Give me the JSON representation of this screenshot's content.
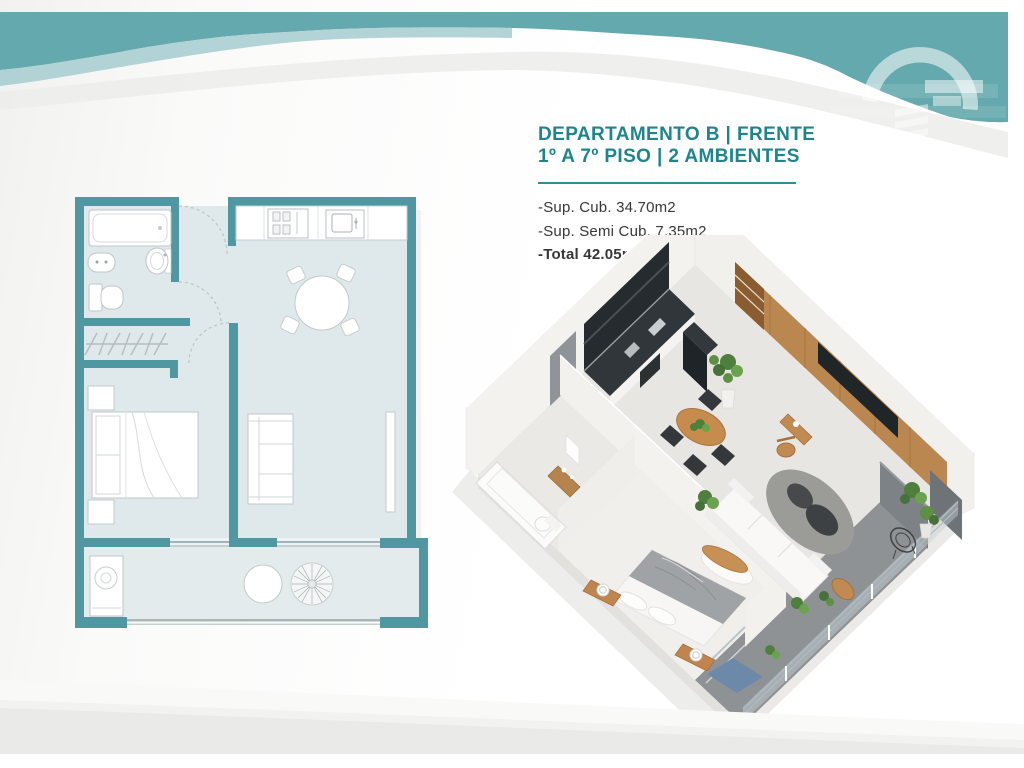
{
  "listing": {
    "title_line1": "DEPARTAMENTO B | FRENTE",
    "title_line2": "1º A 7º PISO | 2 AMBIENTES",
    "details": [
      {
        "label": "-Sup. Cub. 34.70m2",
        "bold": false
      },
      {
        "label": "-Sup. Semi Cub. 7.35m2",
        "bold": false
      },
      {
        "label": "-Total 42.05m2",
        "bold": true
      }
    ]
  },
  "header": {
    "logo": "building-arc-watermark",
    "wave_teal": "#64a9ad",
    "wave_teal_light": "#a6cdd0",
    "wave_gray": "#ececeb"
  },
  "floor_plan": {
    "type": "2d-plan",
    "wall_color": "#4f97a1",
    "floor_color": "#dfe8ea",
    "rooms": [
      "bathroom",
      "closet-hall",
      "bedroom",
      "kitchen",
      "living-dining",
      "balcony"
    ],
    "fixtures": [
      "bathtub",
      "wall-sink",
      "bidet",
      "toilet",
      "wardrobe-rail",
      "double-bed",
      "nightstands",
      "sofa",
      "tv-unit",
      "round-dining-table",
      "four-chairs",
      "kitchen-counter",
      "cooktop",
      "kitchen-sink",
      "washing-machine",
      "balcony-round-table",
      "potted-plant",
      "sliding-glass-doors",
      "door-swing-arcs"
    ]
  },
  "iso_render": {
    "type": "3d-isometric-apartment",
    "features": [
      "white-walls",
      "black-kitchen-with-fridge",
      "entry-doorway",
      "round-wood-dining-table",
      "four-black-chairs",
      "wood-media-wall-with-tv",
      "desk-and-wood-chair",
      "gray-round-rug",
      "dark-coffee-tables",
      "white-sofa",
      "double-bed-gray-blanket",
      "wood-nightstand-trays",
      "foot-bench",
      "blue-rug",
      "bathroom-tub-toilet",
      "entry-wood-cabinet",
      "balcony-dark-floor",
      "glass-railing",
      "wire-chair",
      "balcony-wood-table",
      "potted-plants",
      "gray-accent-walls"
    ],
    "wood_color": "#bb8751",
    "accent_blue": "#6d89aa"
  },
  "colors": {
    "accent_teal_text": "#1f858d",
    "divider_teal": "#2f8d93",
    "body_text": "#373737"
  }
}
